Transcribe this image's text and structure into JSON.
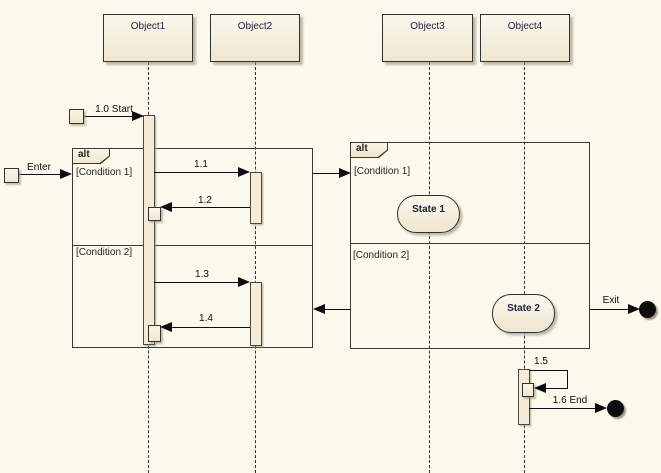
{
  "objects": [
    {
      "label": "Object1"
    },
    {
      "label": "Object2"
    },
    {
      "label": "Object3"
    },
    {
      "label": "Object4"
    }
  ],
  "fragments": {
    "left": {
      "operator": "alt",
      "condition_top": "[Condition 1]",
      "condition_bottom": "[Condition 2]"
    },
    "right": {
      "operator": "alt",
      "condition_top": "[Condition 1]",
      "condition_bottom": "[Condition 2]"
    }
  },
  "messages": {
    "enter": "Enter",
    "start": "1.0 Start",
    "call_1_1": "1.1",
    "return_1_2": "1.2",
    "call_1_3": "1.3",
    "return_1_4": "1.4",
    "self_1_5": "1.5",
    "end_1_6": "1.6 End",
    "exit": "Exit"
  },
  "states": {
    "state1": "State 1",
    "state2": "State 2"
  },
  "colors": {
    "background": "#FCF8EB",
    "shape_fill": "#F4EDDD",
    "shape_border": "#30302A",
    "line": "#0D0D0D",
    "shadow": "#AFAA98"
  }
}
